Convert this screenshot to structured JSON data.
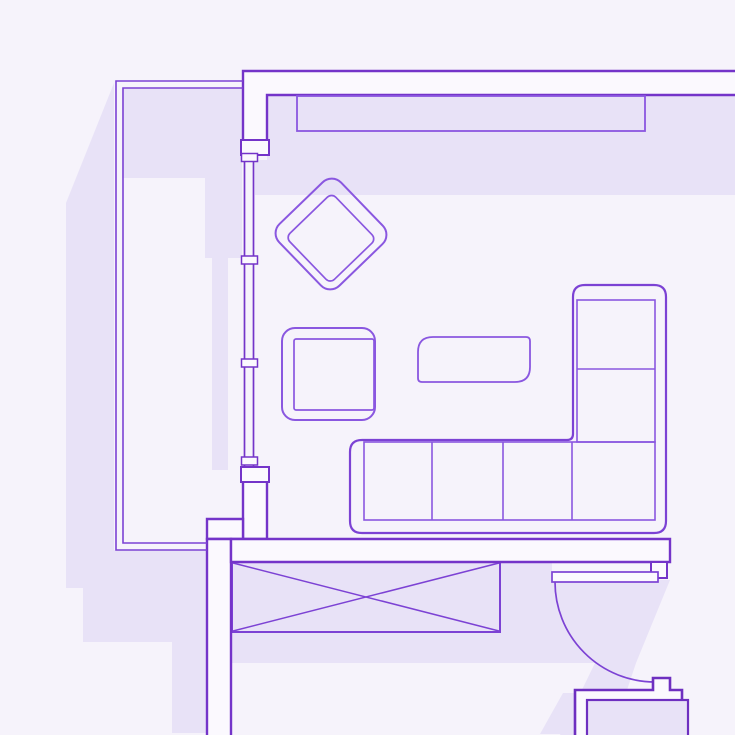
{
  "canvas": {
    "width": 735,
    "height": 735
  },
  "palette": {
    "background": "#f6f3fb",
    "shadow": "#e8e2f7",
    "wall_fill": "#fbf9fe",
    "wall_stroke": "#7434c9",
    "furniture_stroke": "#8a57e0",
    "sofa_stroke": "#7c42d4",
    "heavy_stroke": "#6e2fc0"
  },
  "floorplan": {
    "description": "apartment living-room floor plan, purple line art with lavender drop shadows",
    "elements": [
      {
        "name": "shadow-left-of-balcony",
        "type": "polygon",
        "interactable": false,
        "fill": "shadow",
        "points": [
          [
            114,
            83
          ],
          [
            66,
            203
          ],
          [
            66,
            588
          ],
          [
            83,
            588
          ],
          [
            83,
            642
          ],
          [
            172,
            642
          ],
          [
            172,
            733
          ],
          [
            207,
            733
          ],
          [
            207,
            550
          ],
          [
            114,
            550
          ]
        ]
      },
      {
        "name": "shadow-balcony-interior",
        "type": "polygon",
        "interactable": false,
        "fill": "shadow",
        "points": [
          [
            122,
            88
          ],
          [
            242,
            88
          ],
          [
            242,
            258
          ],
          [
            228,
            258
          ],
          [
            228,
            470
          ],
          [
            212,
            470
          ],
          [
            212,
            258
          ],
          [
            205,
            258
          ],
          [
            205,
            178
          ],
          [
            122,
            178
          ]
        ]
      },
      {
        "name": "shadow-room-top-wall",
        "type": "polygon",
        "interactable": false,
        "fill": "shadow",
        "points": [
          [
            267,
            95
          ],
          [
            737,
            95
          ],
          [
            737,
            195
          ],
          [
            255,
            195
          ],
          [
            255,
            160
          ],
          [
            267,
            160
          ]
        ]
      },
      {
        "name": "shadow-bottom-wall",
        "type": "polygon",
        "interactable": false,
        "fill": "shadow",
        "points": [
          [
            231,
            562
          ],
          [
            552,
            562
          ],
          [
            552,
            663
          ],
          [
            231,
            663
          ]
        ]
      },
      {
        "name": "shadow-door-swing",
        "type": "polygon",
        "interactable": false,
        "fill": "shadow",
        "points": [
          [
            552,
            580
          ],
          [
            670,
            580
          ],
          [
            636,
            663
          ],
          [
            612,
            735
          ],
          [
            560,
            735
          ],
          [
            595,
            663
          ],
          [
            552,
            663
          ]
        ]
      },
      {
        "name": "shadow-appliance",
        "type": "polygon",
        "interactable": false,
        "fill": "shadow",
        "points": [
          [
            563,
            693
          ],
          [
            575,
            693
          ],
          [
            575,
            734
          ],
          [
            540,
            734
          ]
        ]
      },
      {
        "name": "wardrobe-crossed-box",
        "type": "group",
        "interactable": true,
        "children": [
          {
            "name": "wardrobe-outline",
            "type": "rect",
            "x": 232,
            "y": 562,
            "w": 268,
            "h": 70,
            "fill": "shadow",
            "stroke": "sofa_stroke",
            "sw": 2
          },
          {
            "name": "wardrobe-diagonal-1",
            "type": "line",
            "x1": 233,
            "y1": 563,
            "x2": 499,
            "y2": 631,
            "stroke": "sofa_stroke",
            "sw": 1.5
          },
          {
            "name": "wardrobe-diagonal-2",
            "type": "line",
            "x1": 233,
            "y1": 631,
            "x2": 499,
            "y2": 563,
            "stroke": "sofa_stroke",
            "sw": 1.5
          }
        ]
      },
      {
        "name": "wall-top",
        "type": "polygon",
        "interactable": false,
        "fill": "wall_fill",
        "stroke": "wall_stroke",
        "sw": 2.4,
        "points": [
          [
            243,
            71
          ],
          [
            737,
            71
          ],
          [
            737,
            95
          ],
          [
            267,
            95
          ],
          [
            267,
            154
          ],
          [
            243,
            154
          ]
        ]
      },
      {
        "name": "wall-left-lower",
        "type": "polygon",
        "interactable": false,
        "fill": "wall_fill",
        "stroke": "wall_stroke",
        "sw": 2.4,
        "points": [
          [
            243,
            474
          ],
          [
            267,
            474
          ],
          [
            267,
            539
          ],
          [
            243,
            539
          ]
        ]
      },
      {
        "name": "wall-jog",
        "type": "polygon",
        "interactable": false,
        "fill": "wall_fill",
        "stroke": "wall_stroke",
        "sw": 2.4,
        "points": [
          [
            207,
            519
          ],
          [
            243,
            519
          ],
          [
            243,
            539
          ],
          [
            207,
            539
          ]
        ]
      },
      {
        "name": "wall-corridor",
        "type": "polygon",
        "interactable": false,
        "fill": "wall_fill",
        "stroke": "wall_stroke",
        "sw": 2.4,
        "points": [
          [
            207,
            539
          ],
          [
            231,
            539
          ],
          [
            231,
            737
          ],
          [
            207,
            737
          ]
        ]
      },
      {
        "name": "wall-bottom",
        "type": "polygon",
        "interactable": false,
        "fill": "wall_fill",
        "stroke": "wall_stroke",
        "sw": 2.4,
        "points": [
          [
            231,
            539
          ],
          [
            670,
            539
          ],
          [
            670,
            562
          ],
          [
            231,
            562
          ]
        ]
      },
      {
        "name": "wall-door-jamb",
        "type": "polygon",
        "interactable": false,
        "fill": "wall_fill",
        "stroke": "wall_stroke",
        "sw": 2,
        "points": [
          [
            651,
            562
          ],
          [
            667,
            562
          ],
          [
            667,
            578
          ],
          [
            651,
            578
          ]
        ]
      },
      {
        "name": "wall-window-cap-top",
        "type": "polygon",
        "interactable": false,
        "fill": "wall_fill",
        "stroke": "wall_stroke",
        "sw": 2,
        "points": [
          [
            241,
            140
          ],
          [
            269,
            140
          ],
          [
            269,
            155
          ],
          [
            241,
            155
          ]
        ]
      },
      {
        "name": "wall-window-cap-bottom",
        "type": "polygon",
        "interactable": false,
        "fill": "wall_fill",
        "stroke": "wall_stroke",
        "sw": 2,
        "points": [
          [
            241,
            467
          ],
          [
            269,
            467
          ],
          [
            269,
            482
          ],
          [
            241,
            482
          ]
        ]
      },
      {
        "name": "window-strip",
        "type": "group",
        "interactable": true,
        "children": [
          {
            "name": "window-glass-line-outer",
            "type": "line",
            "x1": 244.5,
            "y1": 155,
            "x2": 244.5,
            "y2": 467,
            "stroke": "wall_stroke",
            "sw": 1.7
          },
          {
            "name": "window-glass-line-inner",
            "type": "line",
            "x1": 253.5,
            "y1": 155,
            "x2": 253.5,
            "y2": 467,
            "stroke": "wall_stroke",
            "sw": 1.7
          },
          {
            "name": "window-mullion-1",
            "type": "rect",
            "x": 241.5,
            "y": 153.5,
            "w": 16,
            "h": 8,
            "fill": "wall_fill",
            "stroke": "wall_stroke",
            "sw": 1.5
          },
          {
            "name": "window-mullion-2",
            "type": "rect",
            "x": 241.5,
            "y": 256,
            "w": 16,
            "h": 8,
            "fill": "wall_fill",
            "stroke": "wall_stroke",
            "sw": 1.5
          },
          {
            "name": "window-mullion-3",
            "type": "rect",
            "x": 241.5,
            "y": 359,
            "w": 16,
            "h": 8,
            "fill": "wall_fill",
            "stroke": "wall_stroke",
            "sw": 1.5
          },
          {
            "name": "window-mullion-4",
            "type": "rect",
            "x": 241.5,
            "y": 457,
            "w": 16,
            "h": 8,
            "fill": "wall_fill",
            "stroke": "wall_stroke",
            "sw": 1.5
          }
        ]
      },
      {
        "name": "balcony-outline",
        "type": "group",
        "interactable": false,
        "children": [
          {
            "name": "balcony-outer-line",
            "type": "path",
            "d": "M 243 81 H 116 V 550 H 207",
            "fill": "none",
            "stroke": "sofa_stroke",
            "sw": 1.6
          },
          {
            "name": "balcony-inner-line",
            "type": "path",
            "d": "M 243 88 H 123 V 543 H 207",
            "fill": "none",
            "stroke": "sofa_stroke",
            "sw": 1.6
          }
        ]
      },
      {
        "name": "wall-shelf",
        "type": "rect",
        "interactable": true,
        "x": 297,
        "y": 96,
        "w": 348,
        "h": 35,
        "fill": "none",
        "stroke": "furniture_stroke",
        "sw": 1.8
      },
      {
        "name": "diamond-armchair",
        "type": "group",
        "interactable": true,
        "transform": "rotate(46 331 234)",
        "children": [
          {
            "name": "diamond-armchair-outer",
            "type": "rect",
            "x": 288,
            "y": 191,
            "w": 86,
            "h": 86,
            "rx": 13,
            "fill": "none",
            "stroke": "furniture_stroke",
            "sw": 2
          },
          {
            "name": "diamond-armchair-seat",
            "type": "rect",
            "x": 302,
            "y": 205,
            "w": 64,
            "h": 64,
            "rx": 6,
            "fill": "none",
            "stroke": "furniture_stroke",
            "sw": 1.7
          }
        ]
      },
      {
        "name": "square-armchair",
        "type": "group",
        "interactable": true,
        "children": [
          {
            "name": "square-armchair-outer",
            "type": "rect",
            "x": 282,
            "y": 328,
            "w": 93,
            "h": 92,
            "rx": 13,
            "fill": "none",
            "stroke": "furniture_stroke",
            "sw": 2
          },
          {
            "name": "square-armchair-seat",
            "type": "rect",
            "x": 294,
            "y": 339,
            "w": 80,
            "h": 71,
            "rx": 2,
            "fill": "none",
            "stroke": "furniture_stroke",
            "sw": 1.7
          }
        ]
      },
      {
        "name": "coffee-table",
        "type": "path",
        "interactable": true,
        "d": "M 433 337 H 526 Q 530 337 530 341 V 367 Q 530 382 515 382 H 422 Q 418 382 418 378 V 352 Q 418 337 433 337 Z",
        "fill": "none",
        "stroke": "furniture_stroke",
        "sw": 1.8
      },
      {
        "name": "sectional-sofa",
        "type": "group",
        "interactable": true,
        "children": [
          {
            "name": "sofa-outer-outline",
            "type": "path",
            "d": "M 585 285 H 654 Q 666 285 666 297 V 521 Q 666 533 654 533 H 362 Q 350 533 350 521 V 452 Q 350 440 362 440 H 567 Q 573 440 573 434 V 297 Q 573 285 585 285 Z",
            "fill": "none",
            "stroke": "sofa_stroke",
            "sw": 2.2
          },
          {
            "name": "sofa-seat-band",
            "type": "rect",
            "x": 364,
            "y": 442,
            "w": 291,
            "h": 78,
            "fill": "none",
            "stroke": "furniture_stroke",
            "sw": 1.6
          },
          {
            "name": "sofa-chaise-inner",
            "type": "rect",
            "x": 577,
            "y": 300,
            "w": 78,
            "h": 142,
            "fill": "none",
            "stroke": "furniture_stroke",
            "sw": 1.6
          },
          {
            "name": "sofa-chaise-divider",
            "type": "line",
            "x1": 577,
            "y1": 369,
            "x2": 655,
            "y2": 369,
            "stroke": "furniture_stroke",
            "sw": 1.6
          },
          {
            "name": "sofa-seat-divider-1",
            "type": "line",
            "x1": 432,
            "y1": 442,
            "x2": 432,
            "y2": 520,
            "stroke": "furniture_stroke",
            "sw": 1.6
          },
          {
            "name": "sofa-seat-divider-2",
            "type": "line",
            "x1": 503,
            "y1": 442,
            "x2": 503,
            "y2": 520,
            "stroke": "furniture_stroke",
            "sw": 1.6
          },
          {
            "name": "sofa-seat-divider-3",
            "type": "line",
            "x1": 572,
            "y1": 442,
            "x2": 572,
            "y2": 520,
            "stroke": "furniture_stroke",
            "sw": 1.6
          }
        ]
      },
      {
        "name": "door",
        "type": "group",
        "interactable": true,
        "children": [
          {
            "name": "door-swing-arc",
            "type": "path",
            "d": "M 555 582 A 100 100 0 0 0 655 682",
            "fill": "none",
            "stroke": "sofa_stroke",
            "sw": 1.7
          },
          {
            "name": "door-leaf",
            "type": "rect",
            "x": 552,
            "y": 572,
            "w": 106,
            "h": 10,
            "fill": "wall_fill",
            "stroke": "sofa_stroke",
            "sw": 1.7
          }
        ]
      },
      {
        "name": "appliance",
        "type": "group",
        "interactable": true,
        "children": [
          {
            "name": "appliance-outer-outline",
            "type": "path",
            "d": "M 575 737 V 690 H 653 V 678 H 670 V 690 H 682 V 737",
            "fill": "wall_fill",
            "stroke": "heavy_stroke",
            "sw": 2.6
          },
          {
            "name": "appliance-inner-panel",
            "type": "rect",
            "x": 587,
            "y": 700,
            "w": 101,
            "h": 37,
            "fill": "shadow",
            "stroke": "heavy_stroke",
            "sw": 2.2
          }
        ]
      }
    ]
  }
}
